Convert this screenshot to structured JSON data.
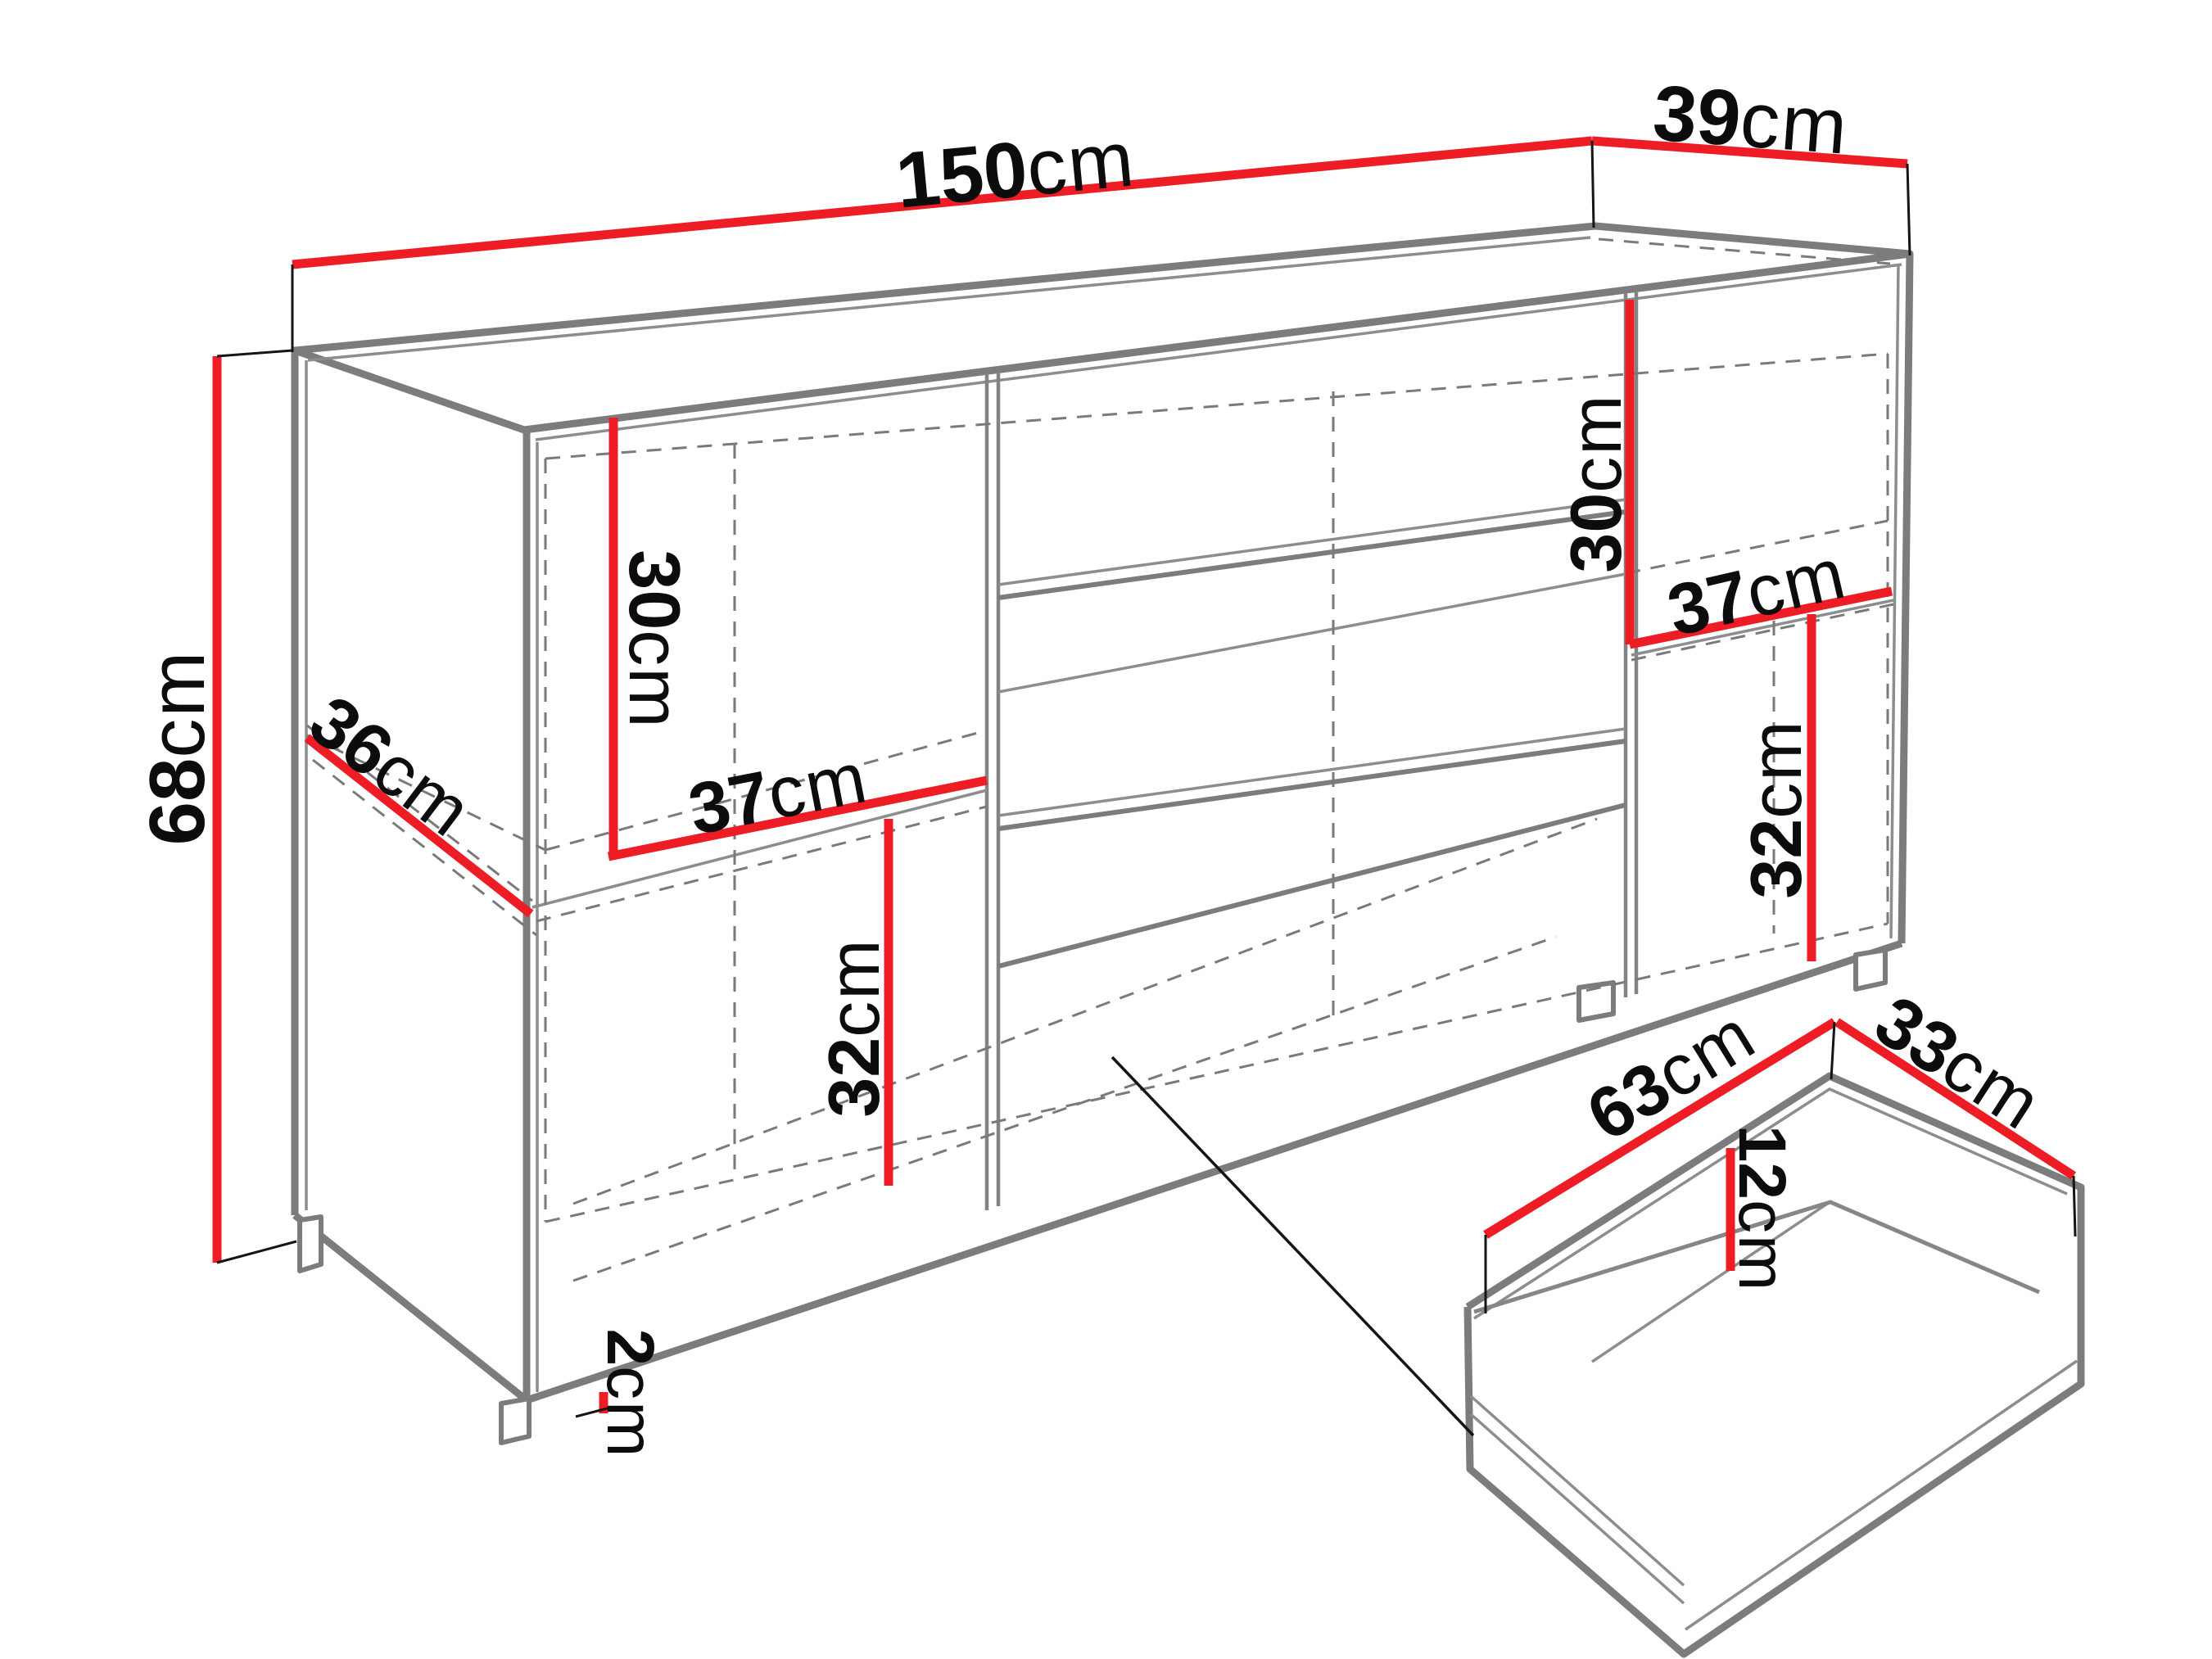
{
  "diagram": {
    "kind": "furniture dimension drawing",
    "subject": "sideboard cabinet with separate drawer detail",
    "units": "cm"
  },
  "colors": {
    "dimension_line": "#ee1c25",
    "outline_gray": "#7c7c7c",
    "label_black": "#0c0c0c",
    "background": "#ffffff"
  },
  "dimensions": {
    "width": {
      "value": "150",
      "unit": "cm"
    },
    "depth": {
      "value": "39",
      "unit": "cm"
    },
    "height": {
      "value": "68",
      "unit": "cm"
    },
    "left_upper_height": {
      "value": "30",
      "unit": "cm"
    },
    "shelf_depth": {
      "value": "36",
      "unit": "cm"
    },
    "left_shelf_width": {
      "value": "37",
      "unit": "cm"
    },
    "left_lower_height": {
      "value": "32",
      "unit": "cm"
    },
    "right_upper_height": {
      "value": "30",
      "unit": "cm"
    },
    "right_shelf_width": {
      "value": "37",
      "unit": "cm"
    },
    "right_lower_height": {
      "value": "32",
      "unit": "cm"
    },
    "foot_height": {
      "value": "2",
      "unit": "cm"
    },
    "drawer_width": {
      "value": "63",
      "unit": "cm"
    },
    "drawer_depth": {
      "value": "33",
      "unit": "cm"
    },
    "drawer_height": {
      "value": "12",
      "unit": "cm"
    }
  }
}
